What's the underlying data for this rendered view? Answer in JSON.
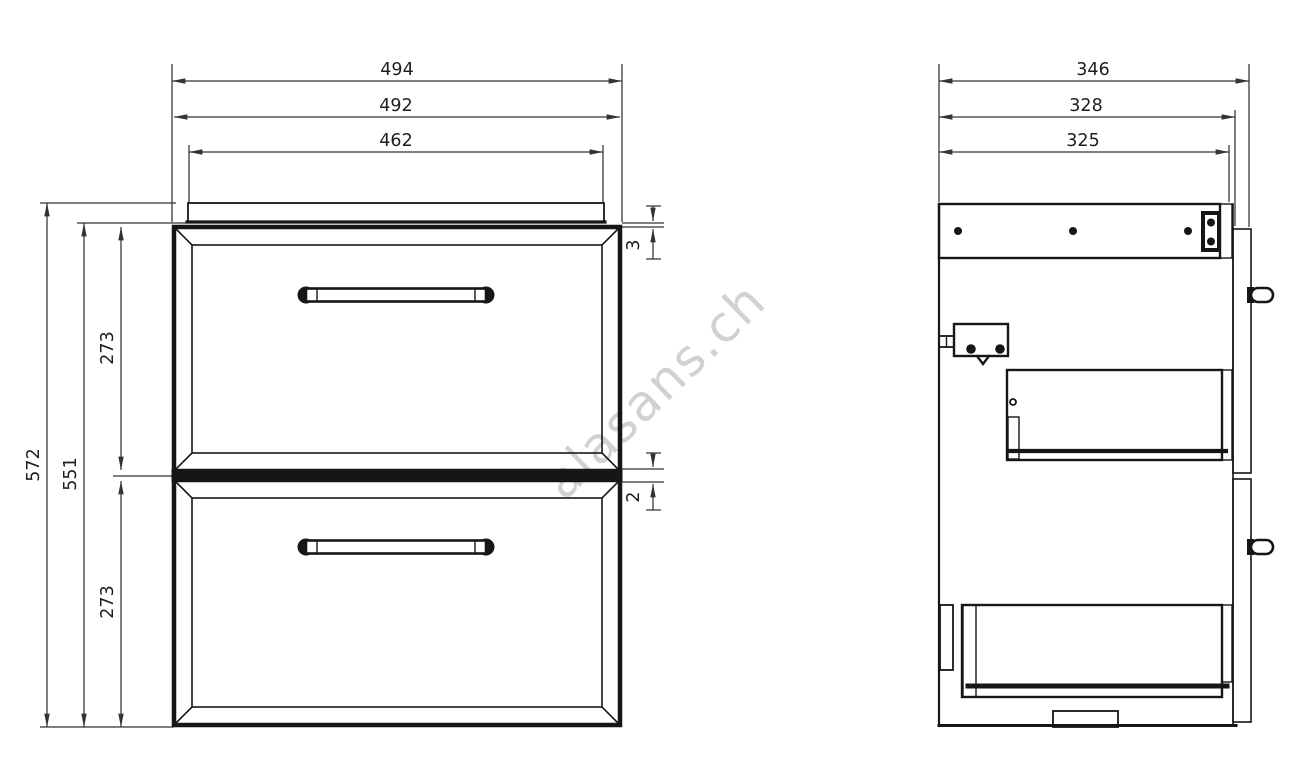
{
  "watermark": {
    "text": "alasans.ch"
  },
  "front_view": {
    "width_dims": {
      "overall": "494",
      "body": "492",
      "top_panel": "462"
    },
    "height_dims": {
      "overall": "572",
      "front": "551",
      "top_drawer": "273",
      "bottom_drawer": "273"
    },
    "gap_dims": {
      "top_gap": "3",
      "middle_gap": "2"
    }
  },
  "side_view": {
    "depth_dims": {
      "overall": "346",
      "body": "328",
      "carcass": "325"
    }
  },
  "colors": {
    "line": "#161616",
    "dim_line": "#333333",
    "text": "#1e1e1e",
    "watermark": "#c9c9c9",
    "background": "#ffffff"
  }
}
